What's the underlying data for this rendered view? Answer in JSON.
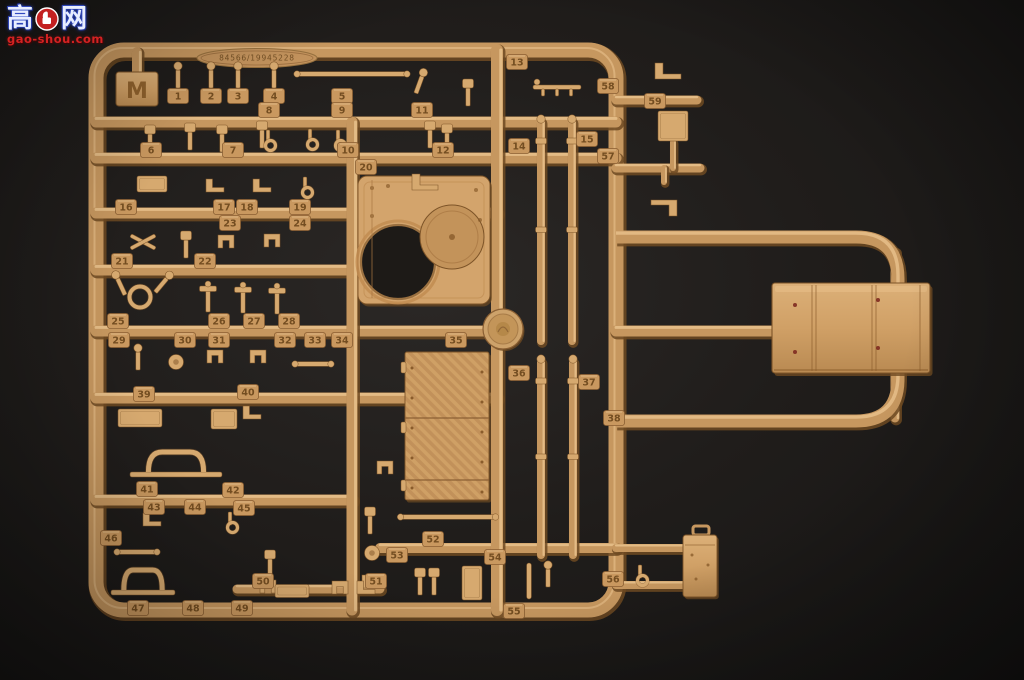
{
  "watermark": {
    "char_left": "高",
    "char_right": "网",
    "logo": "thumbs-up-badge-icon",
    "site": "gao-shou.com",
    "badge_color": "#c32020",
    "text_color": "#d42222"
  },
  "sprue": {
    "letter": "M",
    "kit_number": "84566/19945228",
    "plastic_color": "#c6975f",
    "part_highlight": "#e9c28c",
    "part_shadow": "#6e4a22",
    "background_color": "#1c1a18",
    "frame": {
      "x": 96,
      "y": 50,
      "w": 520,
      "h": 560,
      "rx": 28,
      "sw": 15
    },
    "m_tab": {
      "x": 116,
      "y": 72,
      "w": 42,
      "h": 34
    },
    "oval_plate": {
      "cx": 257,
      "cy": 58,
      "rx": 60,
      "ry": 9.5
    },
    "loop_path": {
      "d": "M 616 237 H 856 Q 898 237 898 279 V 379 Q 898 421 856 421 H 616",
      "sw": 13
    },
    "runners": [
      [
        96,
        122,
        616,
        122,
        11
      ],
      [
        96,
        158,
        616,
        158,
        11
      ],
      [
        96,
        213,
        497,
        213,
        11
      ],
      [
        96,
        270,
        352,
        270,
        11
      ],
      [
        96,
        331,
        497,
        331,
        11
      ],
      [
        96,
        398,
        497,
        398,
        11
      ],
      [
        96,
        500,
        352,
        500,
        11
      ],
      [
        380,
        548,
        616,
        548,
        10
      ],
      [
        237,
        589,
        380,
        589,
        9
      ],
      [
        352,
        122,
        352,
        610,
        11
      ],
      [
        497,
        50,
        497,
        610,
        12
      ],
      [
        616,
        100,
        697,
        100,
        9
      ],
      [
        616,
        168,
        700,
        168,
        9
      ],
      [
        616,
        331,
        775,
        331,
        11
      ],
      [
        616,
        548,
        683,
        548,
        8
      ],
      [
        616,
        585,
        683,
        585,
        8
      ],
      [
        673,
        142,
        673,
        168,
        6
      ],
      [
        664,
        168,
        664,
        182,
        6
      ],
      [
        895,
        252,
        895,
        286,
        9
      ],
      [
        895,
        370,
        895,
        418,
        9
      ],
      [
        137,
        52,
        137,
        74,
        10
      ]
    ],
    "tubes": [
      [
        541,
        116,
        344
      ],
      [
        572,
        116,
        344
      ],
      [
        541,
        356,
        558
      ],
      [
        573,
        356,
        558
      ]
    ],
    "part_numbers": [
      [
        1,
        178,
        96
      ],
      [
        2,
        211,
        96
      ],
      [
        3,
        238,
        96
      ],
      [
        4,
        274,
        96
      ],
      [
        5,
        342,
        96
      ],
      [
        6,
        151,
        150
      ],
      [
        7,
        233,
        150
      ],
      [
        8,
        269,
        110
      ],
      [
        9,
        342,
        110
      ],
      [
        10,
        348,
        150
      ],
      [
        11,
        422,
        110
      ],
      [
        12,
        443,
        150
      ],
      [
        13,
        517,
        62
      ],
      [
        14,
        519,
        146
      ],
      [
        15,
        587,
        139
      ],
      [
        16,
        126,
        207
      ],
      [
        17,
        224,
        207
      ],
      [
        18,
        247,
        207
      ],
      [
        19,
        300,
        207
      ],
      [
        20,
        366,
        167
      ],
      [
        21,
        122,
        261
      ],
      [
        22,
        205,
        261
      ],
      [
        23,
        230,
        223
      ],
      [
        24,
        300,
        223
      ],
      [
        25,
        118,
        321
      ],
      [
        26,
        219,
        321
      ],
      [
        27,
        254,
        321
      ],
      [
        28,
        289,
        321
      ],
      [
        29,
        119,
        340
      ],
      [
        30,
        185,
        340
      ],
      [
        31,
        219,
        340
      ],
      [
        32,
        285,
        340
      ],
      [
        33,
        315,
        340
      ],
      [
        34,
        342,
        340
      ],
      [
        35,
        456,
        340
      ],
      [
        36,
        519,
        373
      ],
      [
        37,
        589,
        382
      ],
      [
        38,
        614,
        418
      ],
      [
        39,
        144,
        394
      ],
      [
        40,
        248,
        392
      ],
      [
        41,
        147,
        489
      ],
      [
        42,
        233,
        490
      ],
      [
        43,
        154,
        507
      ],
      [
        44,
        195,
        507
      ],
      [
        45,
        244,
        508
      ],
      [
        46,
        111,
        538
      ],
      [
        47,
        138,
        608
      ],
      [
        48,
        193,
        608
      ],
      [
        49,
        242,
        608
      ],
      [
        50,
        263,
        581
      ],
      [
        51,
        376,
        581
      ],
      [
        52,
        433,
        539
      ],
      [
        53,
        397,
        555
      ],
      [
        54,
        495,
        557
      ],
      [
        55,
        514,
        611
      ],
      [
        56,
        613,
        579
      ],
      [
        57,
        608,
        156
      ],
      [
        58,
        608,
        86
      ],
      [
        59,
        655,
        101
      ]
    ],
    "small_parts": [
      [
        "pin",
        178,
        76,
        0
      ],
      [
        "pin",
        211,
        76,
        0
      ],
      [
        "pin",
        238,
        76,
        0
      ],
      [
        "pin",
        274,
        76,
        0
      ],
      [
        "rodh",
        352,
        74,
        0,
        110
      ],
      [
        "pin",
        420,
        82,
        20
      ],
      [
        "paddle",
        468,
        92,
        0
      ],
      [
        "tbar",
        557,
        87,
        0
      ],
      [
        "paddle",
        150,
        138,
        0
      ],
      [
        "paddle",
        190,
        136,
        0
      ],
      [
        "paddle",
        222,
        138,
        0
      ],
      [
        "paddle",
        262,
        134,
        0
      ],
      [
        "hook",
        268,
        142,
        0
      ],
      [
        "hook",
        310,
        141,
        0
      ],
      [
        "hook",
        338,
        142,
        0
      ],
      [
        "paddle",
        430,
        134,
        0
      ],
      [
        "paddle",
        447,
        137,
        0
      ],
      [
        "blockl",
        152,
        184,
        0,
        30,
        16
      ],
      [
        "bracket",
        215,
        187,
        0
      ],
      [
        "bracket",
        262,
        187,
        0
      ],
      [
        "hook",
        305,
        189,
        0
      ],
      [
        "lbracket",
        425,
        187,
        0
      ],
      [
        "xcross",
        143,
        242,
        0
      ],
      [
        "paddle",
        186,
        244,
        0
      ],
      [
        "clamp",
        226,
        244,
        0
      ],
      [
        "clamp",
        272,
        243,
        0
      ],
      [
        "ring",
        140,
        297,
        0
      ],
      [
        "pin",
        163,
        283,
        40
      ],
      [
        "pin",
        120,
        284,
        -25
      ],
      [
        "tpin",
        208,
        298,
        0
      ],
      [
        "tpin",
        243,
        299,
        0
      ],
      [
        "tpin",
        277,
        300,
        0
      ],
      [
        "pin",
        138,
        358,
        0
      ],
      [
        "disc",
        176,
        362,
        0
      ],
      [
        "clamp",
        215,
        359,
        0
      ],
      [
        "clamp",
        258,
        359,
        0
      ],
      [
        "rodh",
        313,
        364,
        0,
        36
      ],
      [
        "blockl",
        140,
        418,
        0,
        44,
        18
      ],
      [
        "blockl",
        224,
        419,
        0,
        26,
        20
      ],
      [
        "bracket",
        252,
        414,
        0
      ],
      [
        "arch",
        176,
        468,
        0,
        92
      ],
      [
        "clamp",
        385,
        470,
        0
      ],
      [
        "bracket",
        152,
        521,
        0
      ],
      [
        "hook",
        230,
        524,
        0
      ],
      [
        "paddle",
        370,
        520,
        0
      ],
      [
        "disc",
        372,
        553,
        0
      ],
      [
        "clamp",
        370,
        584,
        0
      ],
      [
        "rodh",
        137,
        552,
        0,
        40
      ],
      [
        "arch",
        143,
        586,
        0,
        64
      ],
      [
        "paddle",
        270,
        563,
        0
      ],
      [
        "clamp",
        268,
        589,
        0
      ],
      [
        "blockl",
        292,
        591,
        0,
        34,
        13
      ],
      [
        "clamp",
        340,
        590,
        0
      ],
      [
        "bracket",
        366,
        589,
        0
      ],
      [
        "rodh",
        448,
        517,
        0,
        95
      ],
      [
        "paddle",
        420,
        581,
        0
      ],
      [
        "paddle",
        434,
        581,
        0
      ],
      [
        "blockl",
        472,
        583,
        0,
        20,
        34
      ],
      [
        "rodv",
        529,
        581,
        0,
        36
      ],
      [
        "pin",
        548,
        575,
        0
      ],
      [
        "lbracket",
        668,
        76,
        0
      ],
      [
        "blockl",
        673,
        126,
        0,
        30,
        30
      ],
      [
        "lbracket",
        664,
        203,
        180
      ],
      [
        "hook",
        640,
        577,
        0
      ]
    ],
    "turret_panel": {
      "x": 358,
      "y": 176,
      "w": 132,
      "h": 128,
      "hole1": [
        398,
        262,
        37
      ],
      "hole2": [
        452,
        237,
        32
      ]
    },
    "deck_panel": {
      "x": 405,
      "y": 352,
      "w": 84,
      "h": 148,
      "seams": [
        418,
        480
      ]
    },
    "big_box": {
      "x": 772,
      "y": 283,
      "w": 158,
      "h": 90
    },
    "stowage_bin": {
      "x": 683,
      "y": 535,
      "w": 34,
      "h": 62
    },
    "medallion": {
      "x": 503,
      "y": 329,
      "r": 20
    }
  }
}
